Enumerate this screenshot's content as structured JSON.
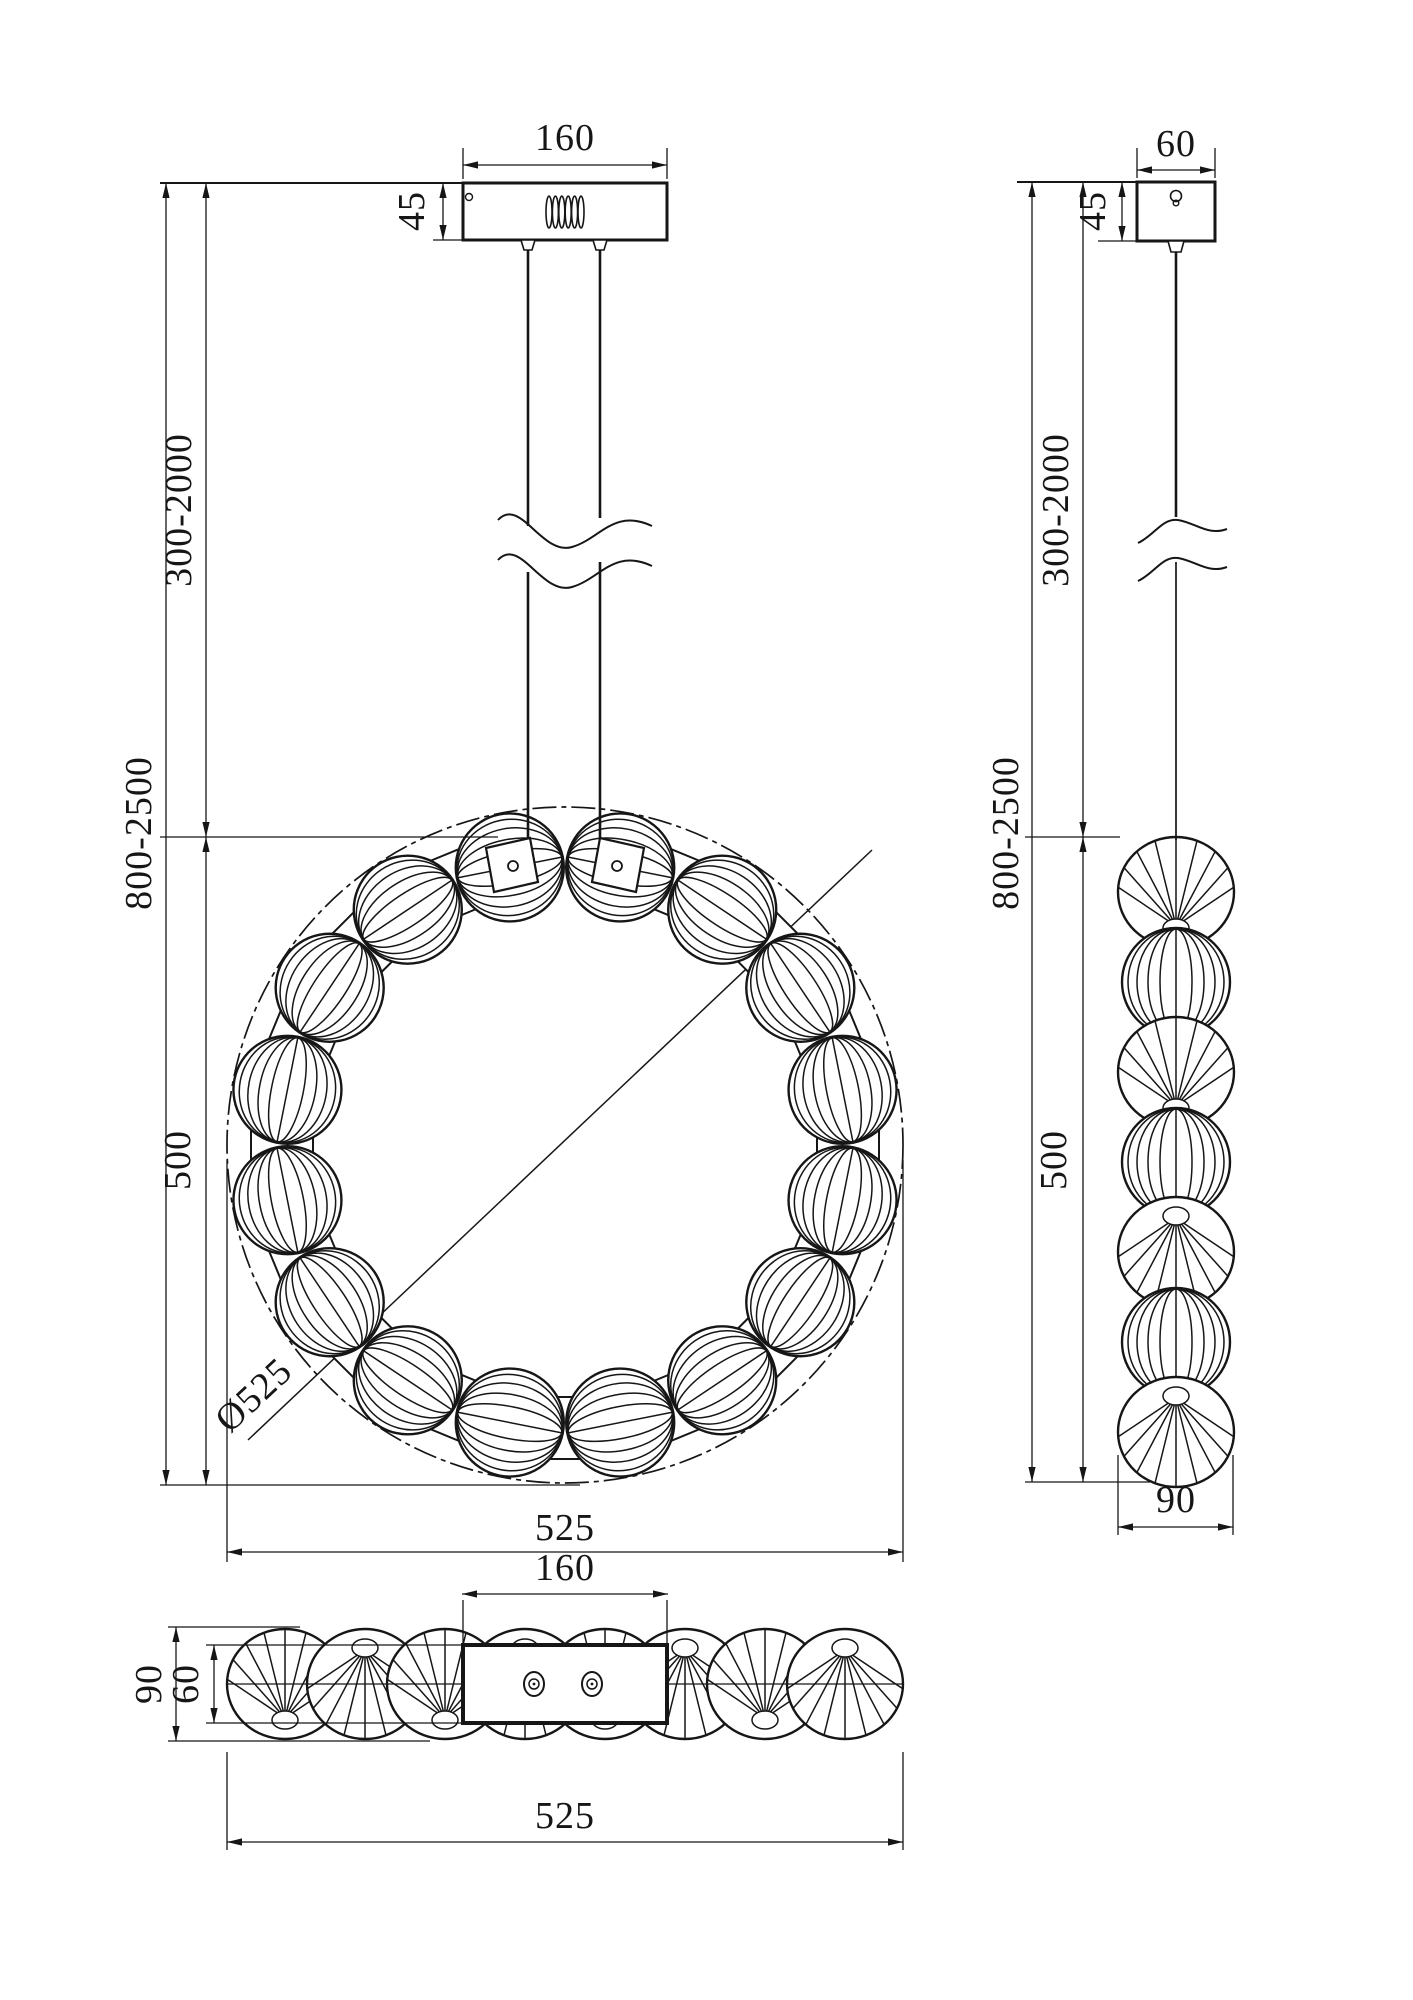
{
  "drawing": {
    "background": "#ffffff",
    "line_color": "#161616",
    "views": {
      "front": {
        "dims": {
          "canopy_width": "160",
          "canopy_height": "45",
          "suspension_range": "300-2000",
          "overall_height_range": "800-2500",
          "ring_height": "500",
          "ring_diameter": "Ø525",
          "overall_width": "525"
        },
        "bead_count": 16
      },
      "side": {
        "dims": {
          "canopy_width": "60",
          "canopy_height": "45",
          "suspension_range": "300-2000",
          "overall_height_range": "800-2500",
          "ring_height": "500",
          "body_width": "90"
        },
        "bead_count": 7
      },
      "bottom": {
        "dims": {
          "plate_width": "160",
          "body_depth": "90",
          "plate_depth": "60",
          "overall_width": "525"
        },
        "bead_count": 8
      }
    }
  }
}
